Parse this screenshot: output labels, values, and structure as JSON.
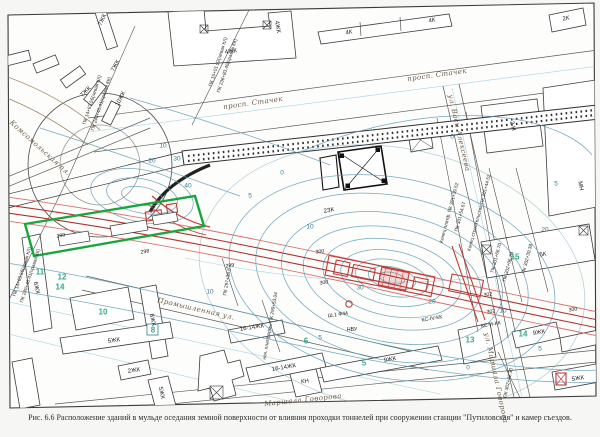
{
  "figure": {
    "number": "Рис. 6.6",
    "caption": "Рис. 6.6 Расположение зданий в мульде оседания земной поверхности от влияния проходки тоннелей при сооружении станции \"Путиловская\" и камер съездов."
  },
  "map": {
    "colors": {
      "settlement_contour_blue": "#5b9bb5",
      "tunnel_red": "#c23b38",
      "highlight_green": "#17a63c",
      "contour_label_teal": "#2f7f95",
      "category_label_green": "#27a07a"
    },
    "street_labels": [
      {
        "t": "просп. Стачек",
        "x": 253,
        "y": 103,
        "r": -8
      },
      {
        "t": "просп. Стачек",
        "x": 437,
        "y": 75,
        "r": -8
      },
      {
        "t": "ул. Васи Алексеева",
        "x": 459,
        "y": 133,
        "r": 77
      },
      {
        "t": "Промышленная ул.",
        "x": 196,
        "y": 309,
        "r": 13
      },
      {
        "t": "Маршала Говорова",
        "x": 303,
        "y": 400,
        "r": -6
      },
      {
        "t": "ул. Маршала Говорова",
        "x": 496,
        "y": 378,
        "r": 78
      },
      {
        "t": "Комсомольская пл.",
        "x": 40,
        "y": 148,
        "r": 42
      }
    ],
    "building_labels": [
      {
        "t": "7ЖК",
        "x": 103,
        "y": 20,
        "r": -65
      },
      {
        "t": "7ЖК",
        "x": 116,
        "y": 66,
        "r": -62
      },
      {
        "t": "7ЖК",
        "x": 86,
        "y": 92,
        "r": -45
      },
      {
        "t": "10ЖК",
        "x": 121,
        "y": 99,
        "r": -62
      },
      {
        "t": "4ЖК",
        "x": 231,
        "y": 52,
        "r": -8
      },
      {
        "t": "4ЖК",
        "x": 277,
        "y": 27,
        "r": 80
      },
      {
        "t": "4К",
        "x": 349,
        "y": 33,
        "r": -8
      },
      {
        "t": "4К",
        "x": 432,
        "y": 21,
        "r": -8
      },
      {
        "t": "2К",
        "x": 566,
        "y": 19,
        "r": -8
      },
      {
        "t": "2-Н",
        "x": 512,
        "y": 126,
        "r": 77
      },
      {
        "t": "МН",
        "x": 580,
        "y": 186,
        "r": 80
      },
      {
        "t": "5К",
        "x": 543,
        "y": 255,
        "r": -8
      },
      {
        "t": "2ЗК",
        "x": 329,
        "y": 211,
        "r": -10
      },
      {
        "t": "6ЖК",
        "x": 36,
        "y": 288,
        "r": 78
      },
      {
        "t": "6ЖК",
        "x": 152,
        "y": 320,
        "r": 78
      },
      {
        "t": "5ЖК",
        "x": 114,
        "y": 341,
        "r": -8
      },
      {
        "t": "2ЖК",
        "x": 134,
        "y": 371,
        "r": -8
      },
      {
        "t": "5ЖК",
        "x": 161,
        "y": 393,
        "r": 78
      },
      {
        "t": "16-14ЖК",
        "x": 252,
        "y": 328,
        "r": -8
      },
      {
        "t": "16-14ЖК",
        "x": 284,
        "y": 368,
        "r": -10
      },
      {
        "t": "КН",
        "x": 305,
        "y": 382,
        "r": -8
      },
      {
        "t": "9ЖК",
        "x": 390,
        "y": 360,
        "r": -10
      },
      {
        "t": "9ЖК",
        "x": 539,
        "y": 333,
        "r": -10
      },
      {
        "t": "5ЖК",
        "x": 578,
        "y": 379,
        "r": -8
      }
    ],
    "infrastructure_labels": [
      {
        "t": "НВУ",
        "x": 352,
        "y": 330,
        "r": 0
      },
      {
        "t": "Ш.1 Ф44",
        "x": 338,
        "y": 315,
        "r": -8
      },
      {
        "t": "КС-И-КК",
        "x": 491,
        "y": 325,
        "r": -10
      },
      {
        "t": "КС-IV-КК",
        "x": 432,
        "y": 319,
        "r": -10
      },
      {
        "t": "298",
        "x": 145,
        "y": 252,
        "r": -9
      },
      {
        "t": "299",
        "x": 61,
        "y": 236,
        "r": -9
      },
      {
        "t": "299",
        "x": 230,
        "y": 266,
        "r": -9
      },
      {
        "t": "300",
        "x": 320,
        "y": 252,
        "r": -9
      },
      {
        "t": "300",
        "x": 324,
        "y": 283,
        "r": -9
      },
      {
        "t": "302",
        "x": 488,
        "y": 295,
        "r": -9
      },
      {
        "t": "302",
        "x": 491,
        "y": 312,
        "r": -9
      },
      {
        "t": "300",
        "x": 573,
        "y": 310,
        "r": -9
      }
    ],
    "picket_labels": [
      {
        "t": "ПК 14+63.56(левая КЛ)",
        "x": 93,
        "y": 100,
        "r": -72
      },
      {
        "t": "ПК 240+40.41(правая КК)",
        "x": 102,
        "y": 104,
        "r": -72
      },
      {
        "t": "ПК 15+01.92(левая КЛ)",
        "x": 219,
        "y": 62,
        "r": -72
      },
      {
        "t": "ПК 236+83.46(правая КК)",
        "x": 228,
        "y": 66,
        "r": -72
      },
      {
        "t": "ПК 14+63.56(левая КЛ)",
        "x": 23,
        "y": 272,
        "r": -72
      },
      {
        "t": "ПК 240+40.41(правая КК)",
        "x": 31,
        "y": 276,
        "r": -72
      },
      {
        "t": "ПК 297+38.8",
        "x": 228,
        "y": 282,
        "r": -80
      },
      {
        "t": "нач. платформы ПК 299+53.04",
        "x": 271,
        "y": 326,
        "r": -80
      },
      {
        "t": "Конец платф. ПК 301+39.52",
        "x": 450,
        "y": 213,
        "r": -75
      },
      {
        "t": "ПК 301+54.57",
        "x": 461,
        "y": 217,
        "r": -75
      },
      {
        "t": "Конец строительства ПК 301+44.52",
        "x": 480,
        "y": 213,
        "r": -75
      },
      {
        "t": "ПК 301+66.70",
        "x": 497,
        "y": 258,
        "r": -75
      },
      {
        "t": "ПК 302+06.70",
        "x": 509,
        "y": 267,
        "r": -75
      },
      {
        "t": "ПК 302+30.38",
        "x": 528,
        "y": 259,
        "r": -75
      },
      {
        "t": "ПК 302+42.30",
        "x": 509,
        "y": 383,
        "r": -78
      }
    ],
    "contour_labels": [
      {
        "t": "10",
        "x": 163,
        "y": 146,
        "r": 0
      },
      {
        "t": "30",
        "x": 177,
        "y": 159,
        "r": 0
      },
      {
        "t": "20",
        "x": 152,
        "y": 161,
        "r": 0
      },
      {
        "t": "40",
        "x": 188,
        "y": 186,
        "r": 0
      },
      {
        "t": "0",
        "x": 282,
        "y": 173,
        "r": 0
      },
      {
        "t": "5",
        "x": 250,
        "y": 196,
        "r": 0
      },
      {
        "t": "10",
        "x": 310,
        "y": 227,
        "r": 0
      },
      {
        "t": "30",
        "x": 360,
        "y": 288,
        "r": 0
      },
      {
        "t": "20",
        "x": 432,
        "y": 302,
        "r": 0
      },
      {
        "t": "0",
        "x": 452,
        "y": 137,
        "r": 0
      },
      {
        "t": "5",
        "x": 556,
        "y": 184,
        "r": 0
      },
      {
        "t": "20",
        "x": 545,
        "y": 230,
        "r": 0
      },
      {
        "t": "10",
        "x": 210,
        "y": 292,
        "r": 0
      },
      {
        "t": "5",
        "x": 320,
        "y": 338,
        "r": 0
      },
      {
        "t": "0",
        "x": 468,
        "y": 368,
        "r": 0
      },
      {
        "t": "5",
        "x": 540,
        "y": 349,
        "r": 0
      },
      {
        "t": "10",
        "x": 503,
        "y": 311,
        "r": 0
      }
    ],
    "category_labels": [
      {
        "t": "11",
        "x": 40,
        "y": 272,
        "r": 0
      },
      {
        "t": "12",
        "x": 62,
        "y": 277,
        "r": 0
      },
      {
        "t": "14",
        "x": 60,
        "y": 287,
        "r": 0
      },
      {
        "t": "10",
        "x": 103,
        "y": 312,
        "r": 0
      },
      {
        "t": "8",
        "x": 153,
        "y": 330,
        "r": 0
      },
      {
        "t": "6",
        "x": 306,
        "y": 341,
        "r": 0
      },
      {
        "t": "5",
        "x": 364,
        "y": 363,
        "r": 0
      },
      {
        "t": "13",
        "x": 470,
        "y": 340,
        "r": 0
      },
      {
        "t": "15",
        "x": 515,
        "y": 257,
        "r": 0
      },
      {
        "t": "14",
        "x": 523,
        "y": 334,
        "r": 0
      }
    ]
  }
}
